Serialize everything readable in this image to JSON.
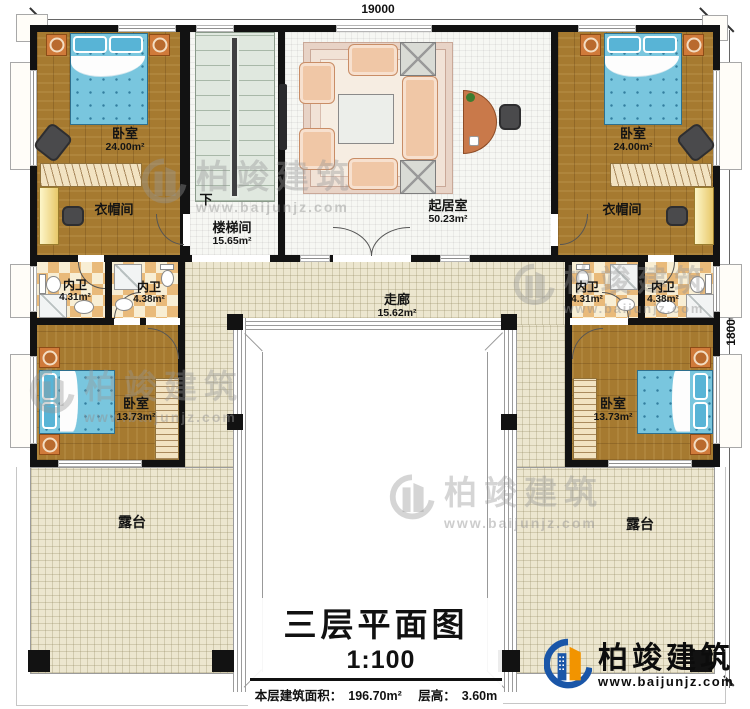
{
  "plan": {
    "dimensions": {
      "top": "19000",
      "right": "18000"
    },
    "rooms": {
      "bedroom_tl": {
        "name": "卧室",
        "area": "24.00m²"
      },
      "bedroom_tr": {
        "name": "卧室",
        "area": "24.00m²"
      },
      "cloakroom_left": {
        "name": "衣帽间"
      },
      "cloakroom_right": {
        "name": "衣帽间"
      },
      "stair": {
        "name": "楼梯间",
        "area": "15.65m²",
        "direction": "下"
      },
      "living": {
        "name": "起居室",
        "area": "50.23m²"
      },
      "bath_left_outer": {
        "name": "内卫",
        "area": "4.31m²"
      },
      "bath_left_inner": {
        "name": "内卫",
        "area": "4.38m²"
      },
      "bath_right_inner": {
        "name": "内卫",
        "area": "4.31m²"
      },
      "bath_right_outer": {
        "name": "内卫",
        "area": "4.38m²"
      },
      "corridor": {
        "name": "走廊",
        "area": "15.62m²"
      },
      "bedroom_bl": {
        "name": "卧室",
        "area": "13.73m²"
      },
      "bedroom_br": {
        "name": "卧室",
        "area": "13.73m²"
      },
      "terrace_left": {
        "name": "露台"
      },
      "terrace_right": {
        "name": "露台"
      }
    },
    "title_block": {
      "title": "三层平面图",
      "scale": "1:100",
      "area_label": "本层建筑面积：",
      "area_value": "196.70m²",
      "floor_height_label": "层高：",
      "floor_height_value": "3.60m"
    },
    "brand": {
      "name": "柏竣建筑",
      "website": "www.baijunjz.com"
    },
    "watermark": {
      "name": "柏竣建筑",
      "website": "www.baijunjz.com"
    },
    "colors": {
      "wall": "#121212",
      "wood_floor": "#a67a30",
      "tile_light": "#f8eed4",
      "tile_dark": "#e9ba7a",
      "paving": "#ece6cf",
      "bed": "#79c6de",
      "sofa": "#f0c7a6",
      "logo_blue": "#1a56a8",
      "logo_orange": "#f29400"
    }
  }
}
